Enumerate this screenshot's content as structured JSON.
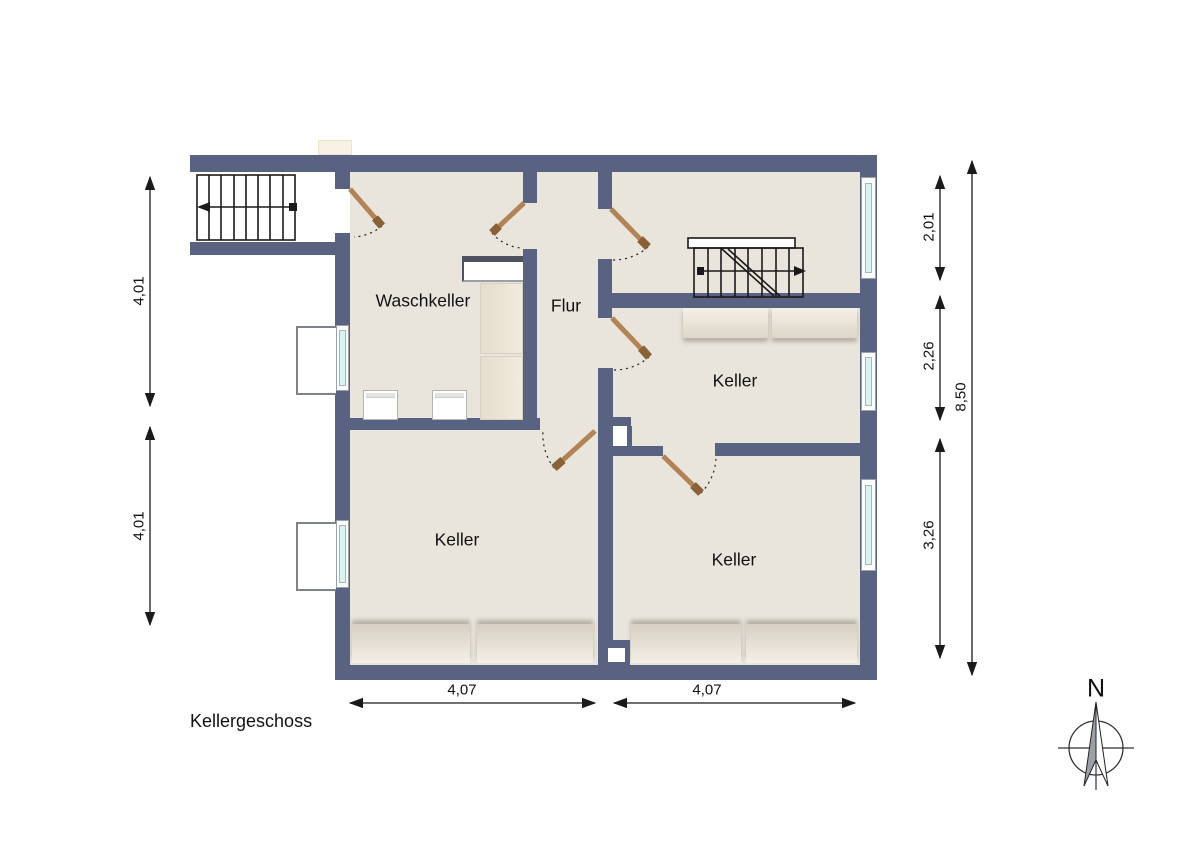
{
  "title": "Kellergeschoss",
  "compass": {
    "label": "N"
  },
  "rooms": [
    {
      "id": "waschkeller",
      "label": "Waschkeller"
    },
    {
      "id": "flur",
      "label": "Flur"
    },
    {
      "id": "keller-mitte",
      "label": "Keller"
    },
    {
      "id": "keller-links",
      "label": "Keller"
    },
    {
      "id": "keller-rechts",
      "label": "Keller"
    }
  ],
  "dimensions": {
    "left": [
      {
        "value": "4,01"
      },
      {
        "value": "4,01"
      }
    ],
    "right": [
      {
        "value": "2,01"
      },
      {
        "value": "2,26"
      },
      {
        "value": "3,26"
      },
      {
        "value": "8,50"
      }
    ],
    "bottom": [
      {
        "value": "4,07"
      },
      {
        "value": "4,07"
      }
    ]
  },
  "colors": {
    "wall": "#5a6281",
    "floor": "#e9e5dc",
    "glass": "#d9f4f6",
    "door": "#b18356",
    "line": "#1a1a1a"
  }
}
